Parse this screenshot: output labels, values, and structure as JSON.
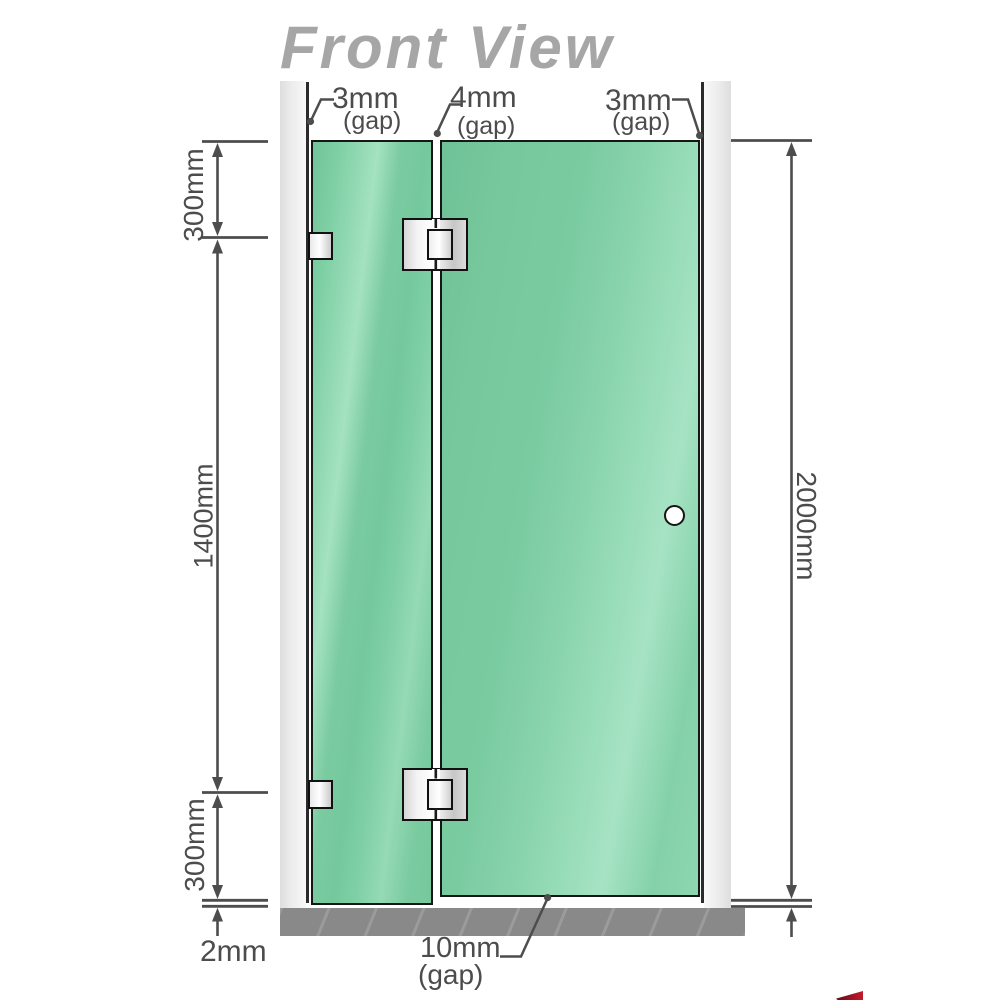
{
  "title": "Front View",
  "measurements": {
    "top_left_gap": "3mm",
    "top_left_gap_sub": "(gap)",
    "top_middle_gap": "4mm",
    "top_middle_gap_sub": "(gap)",
    "top_right_gap": "3mm",
    "top_right_gap_sub": "(gap)",
    "left_segment_top": "300mm",
    "left_segment_middle": "1400mm",
    "left_segment_bottom": "300mm",
    "right_total_height": "2000mm",
    "bottom_floor_gap": "2mm",
    "bottom_door_gap": "10mm",
    "bottom_door_gap_sub": "(gap)"
  },
  "colors": {
    "glass_green": "#7bcba1",
    "glass_highlight": "#a6e3c4",
    "title_gray": "#a6a6a6",
    "dimension_gray": "#4d4d4d",
    "wall_channel_gray": "#e9e9e9",
    "floor_base_gray": "#8d8d8d",
    "outline_black": "#161616",
    "hardware_metal": "#f4f4f4",
    "logo_red": "#a01325"
  }
}
